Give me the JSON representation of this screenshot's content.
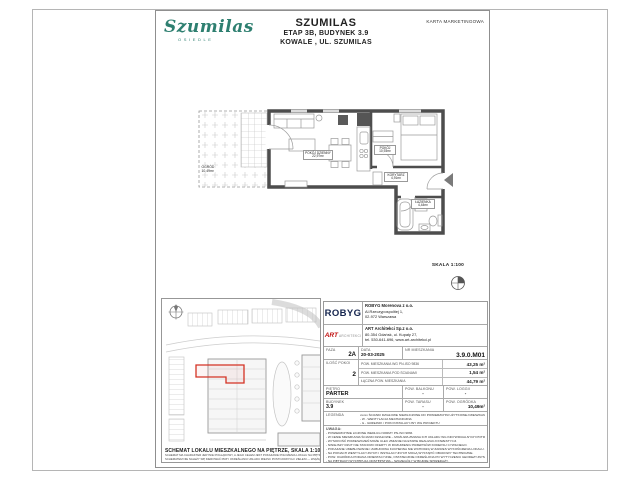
{
  "header": {
    "logo_name": "Szumilas",
    "logo_sub": "OSIEDLE",
    "title": "SZUMILAS",
    "subtitle1": "ETAP 3B, BUDYNEK 3.9",
    "subtitle2": "KOWALE , UL. SZUMILAS",
    "doc_type": "KARTA MARKETINGOWA"
  },
  "floor_plan": {
    "scale_label": "SKALA 1:100",
    "garden": {
      "name": "OGRÓD",
      "area": "10,49m²"
    },
    "rooms": [
      {
        "name": "POKÓJ DZIENNY",
        "area": "22,97m²"
      },
      {
        "name": "POKÓJ",
        "area": "10,93m²"
      },
      {
        "name": "KORYTARZ",
        "area": "4,91m²"
      },
      {
        "name": "ŁAZIENKA",
        "area": "4,44m²"
      }
    ]
  },
  "site_plan": {
    "caption": "SCHEMAT LOKALU MIESZKALNEGO NA PIĘTRZE, SKALA 1:1000",
    "fine_print_1": "SCHEMAT MA CHARAKTER JEDYNIE POGLĄDOWY, A JEGO CELEM JEST POKAZANIE POŁOŻENIA LOKALU NA PIĘTRZE I EWENTUALNYCH ROZBIEŻNOŚCI",
    "fine_print_2": "SCHEMATEM NIE NALEŻY SIĘ KIEROWAĆ PRZY OKREŚLANIU UKŁADU MIEJSC POSTOJOWYCH I ZIELENI — WIĄŻĄCY JEST PROJEKT BUDOWLANY"
  },
  "company": {
    "developer_logo": "ROBYG",
    "developer_name": "ROBYG Morenova z o.o.",
    "developer_addr1": "Al.Rzeczypospolitej 1,",
    "developer_addr2": "02-972 Warszawa",
    "architect_logo_main": "ART",
    "architect_logo_sub": "ARCHITEKCI",
    "architect_name": "ART Architekci Sp.z o.o.",
    "architect_addr1": "80-354 Gdańsk, ul. Kupały 27,",
    "architect_addr2": "tel. 530-641-696, www.art-architekci.pl"
  },
  "details": {
    "faza_label": "FAZA",
    "faza": "2A",
    "data_label": "DATA",
    "data": "20-03-2025",
    "nr_label": "NR MIESZKANIA",
    "nr": "3.9.0.M01",
    "rooms_label": "ILOŚĆ POKOI",
    "rooms": "2",
    "area1_label": "POW. MIESZKANIA WG PN-ISO 9836",
    "area1": "43,25 m²",
    "area2_label": "POW. MIESZKANIA POD ŚCIANAMI",
    "area2": "1,54 m²",
    "area3_label": "ŁĄCZNA POW. MIESZKANIA",
    "area3": "44,79 m²",
    "floor_label": "PIĘTRO",
    "floor": "PARTER",
    "balcony_label": "POW. BALKONU",
    "balcony": "-",
    "loggia_label": "POW. LOGGII",
    "loggia": "-",
    "building_label": "BUDYNEK",
    "building": "3.9",
    "terrace_label": "POW. TARASU",
    "terrace": "-",
    "garden_label": "POW. OGRÓDKA",
    "garden": "10,49m²"
  },
  "legend": {
    "label": "LEGENDA",
    "lines": [
      "xxxxx   ŚCIANKI DZIAŁOWE NIEWLICZONE DO POWIERZCHNI UŻYTKOWEJ MIESZKANIA",
      "- W -   WENTYLACJA MECHANICZNA",
      "- G -   GRZEJNIK / PION INSTALACYJNY WG PROJEKTU",
      "- E -   MIEJSCE ROZDZIELNICY ELEKTRYCZNEJ"
    ]
  },
  "uwaga": {
    "label": "UWAGA:",
    "lines": [
      "- POWIERZCHNIE LICZONE WEDŁUG NORMY PN-ISO 9836.",
      "- W CENIE MIESZKANIA ŚCIANKI DZIAŁOWE – MOŻLIWA ZMIANA ICH UKŁADU WG INDYWIDUALNYCH POTRZEB.",
      "- WYSOKOŚĆ POMIESZCZEŃ MOŻE ULEC ZMIANIE NA ETAPIE REALIZACJI INWESTYCJI.",
      "- NINIEJSZY RZUT NIE STANOWI OFERTY W ROZUMIENIU PRZEPISÓW KODEKSU CYWILNEGO.",
      "- POKAZANE UMEBLOWANIE I ZABUDOWA KUCHENNA NIE WCHODZĄ W ZAKRES WYKOŃCZENIA LOKALU.",
      "- NA PIONACH WENTYLACYJNYCH I INSTALACYJNYCH MOGĄ WYSTĄPIĆ OBUDOWY TECHNICZNE.",
      "- POW. OGRÓDKA PODANA ORIENTACYJNIE, OSTATECZNIE OKREŚLONA PO WYTYCZENIU GEODEZYJNYM.",
      "- NA PIĘTRACH WYSTĘPUJĄ ODSTĘPSTWA – SZCZEGÓŁY W BIURZE SPRZEDAŻY.",
      "- W PRZYPADKU PYTAŃ PROSIMY O KONTAKT Z BIUREM SPRZEDAŻY."
    ]
  }
}
